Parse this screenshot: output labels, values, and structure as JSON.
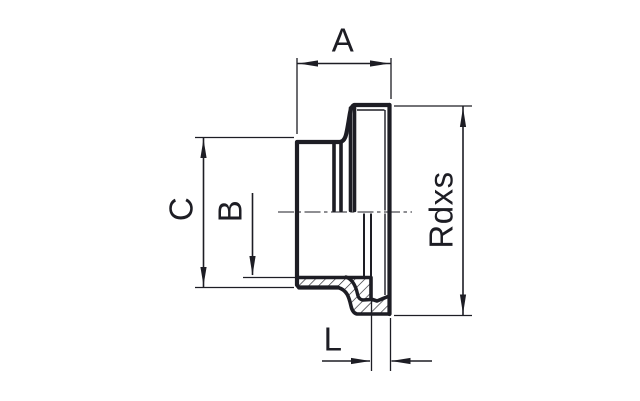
{
  "drawing": {
    "description": "Cross-section technical drawing of a threaded pipe fitting (hose nipple with male thread)",
    "labels": {
      "a": "A",
      "b": "B",
      "c": "C",
      "thread": "Rdxs",
      "l": "L"
    },
    "colors": {
      "line": "#1d1d24",
      "background": "#ffffff"
    }
  }
}
